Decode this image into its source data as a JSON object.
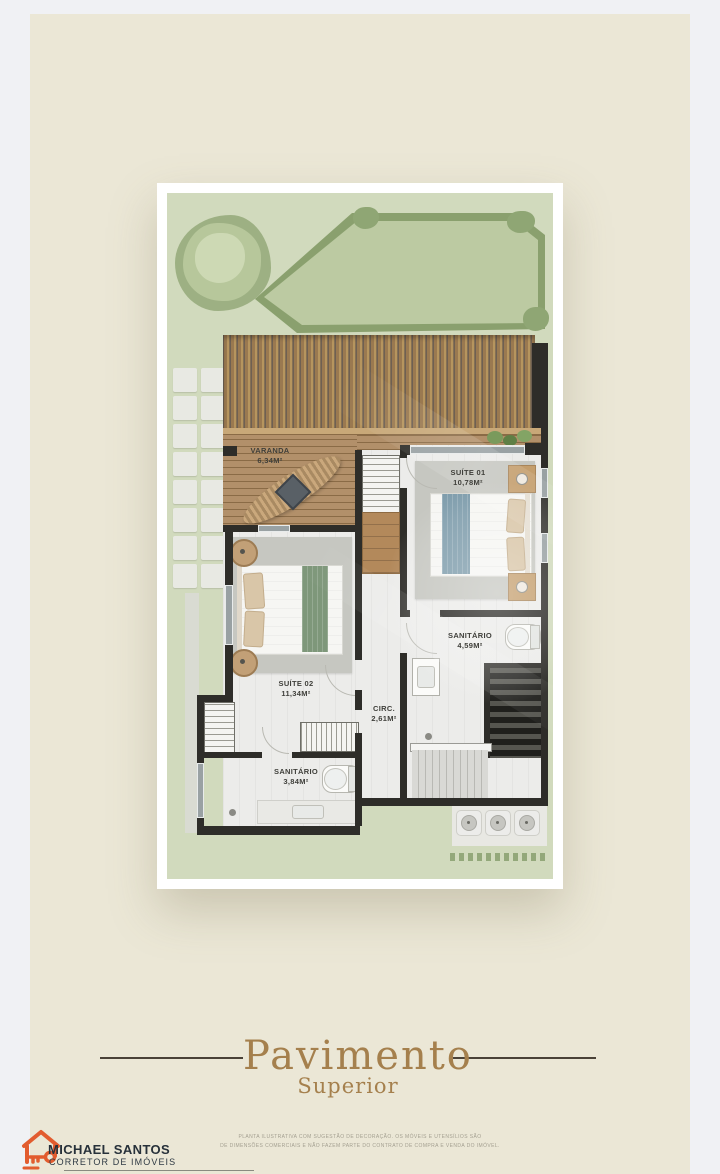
{
  "page": {
    "background": "#f0f1f4",
    "panel_color": "#ebe7d6"
  },
  "floor_plan": {
    "rooms": [
      {
        "name": "VARANDA",
        "area": "6,34M²"
      },
      {
        "name": "SUÍTE 01",
        "area": "10,78M²"
      },
      {
        "name": "SUÍTE 02",
        "area": "11,34M²"
      },
      {
        "name": "SANITÁRIO",
        "area": "4,59M²"
      },
      {
        "name": "CIRC.",
        "area": "2,61M²"
      },
      {
        "name": "SANITÁRIO",
        "area": "3,84M²"
      }
    ]
  },
  "title": {
    "main": "Pavimento",
    "sub": "Superior",
    "accent_color": "#a5804d"
  },
  "footer": {
    "brand_name": "MICHAEL SANTOS",
    "brand_tagline": "CORRETOR DE IMÓVEIS",
    "logo_icon": "house-key-icon",
    "logo_color": "#e25c2e",
    "disclaimer_line1": "PLANTA ILUSTRATIVA COM SUGESTÃO DE DECORAÇÃO. OS MÓVEIS E UTENSÍLIOS SÃO",
    "disclaimer_line2": "DE DIMENSÕES COMERCIAIS E NÃO FAZEM PARTE DO CONTRATO DE COMPRA E VENDA DO IMÓVEL."
  }
}
